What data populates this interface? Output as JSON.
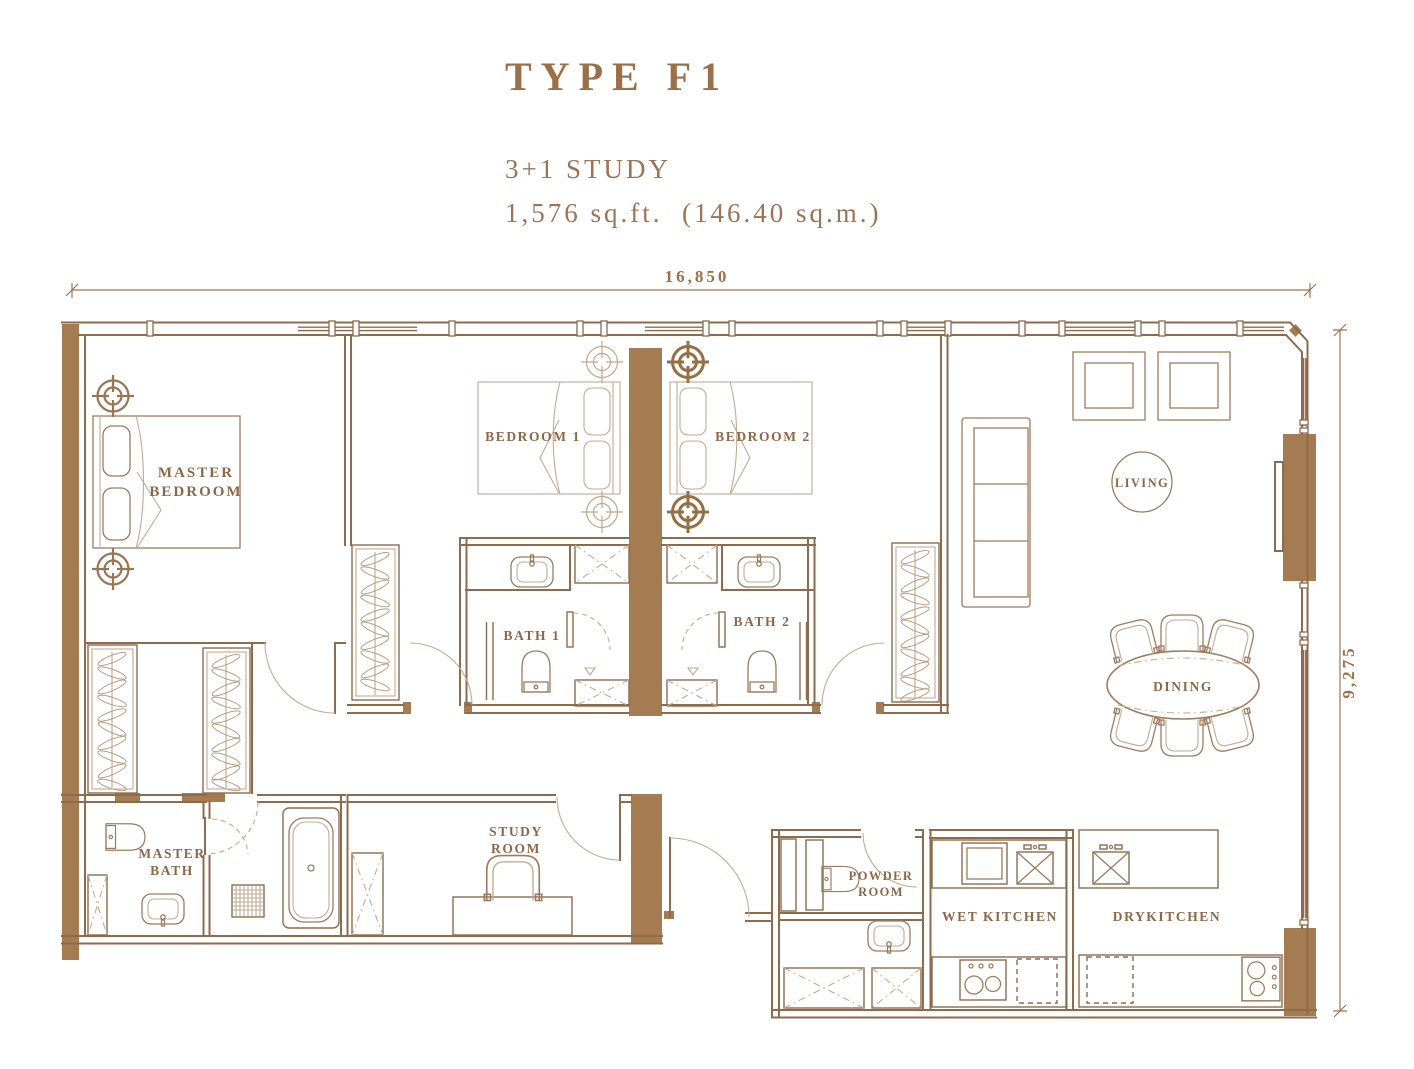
{
  "header": {
    "title": "TYPE F1",
    "subtitle": "3+1 STUDY",
    "area": "1,576 sq.ft.  (146.40 sq.m.)"
  },
  "dimensions": {
    "width": "16,850",
    "height": "9,275"
  },
  "rooms": {
    "master_bedroom": {
      "line1": "MASTER",
      "line2": "BEDROOM"
    },
    "bedroom1": {
      "label": "BEDROOM 1"
    },
    "bedroom2": {
      "label": "BEDROOM 2"
    },
    "bath1": {
      "label": "BATH 1"
    },
    "bath2": {
      "label": "BATH 2"
    },
    "master_bath": {
      "line1": "MASTER",
      "line2": "BATH"
    },
    "study_room": {
      "line1": "STUDY",
      "line2": "ROOM"
    },
    "powder_room": {
      "line1": "POWDER",
      "line2": "ROOM"
    },
    "wet_kitchen": {
      "label": "WET KITCHEN"
    },
    "dry_kitchen": {
      "label": "DRYKITCHEN"
    },
    "living": {
      "label": "LIVING"
    },
    "dining": {
      "label": "DINING"
    }
  },
  "colors": {
    "wall_fill": "#a57c52",
    "line": "#8d6b4c",
    "light_line": "#c2ab92",
    "label_text": "#8d6848",
    "title_text": "#9c6f48"
  }
}
